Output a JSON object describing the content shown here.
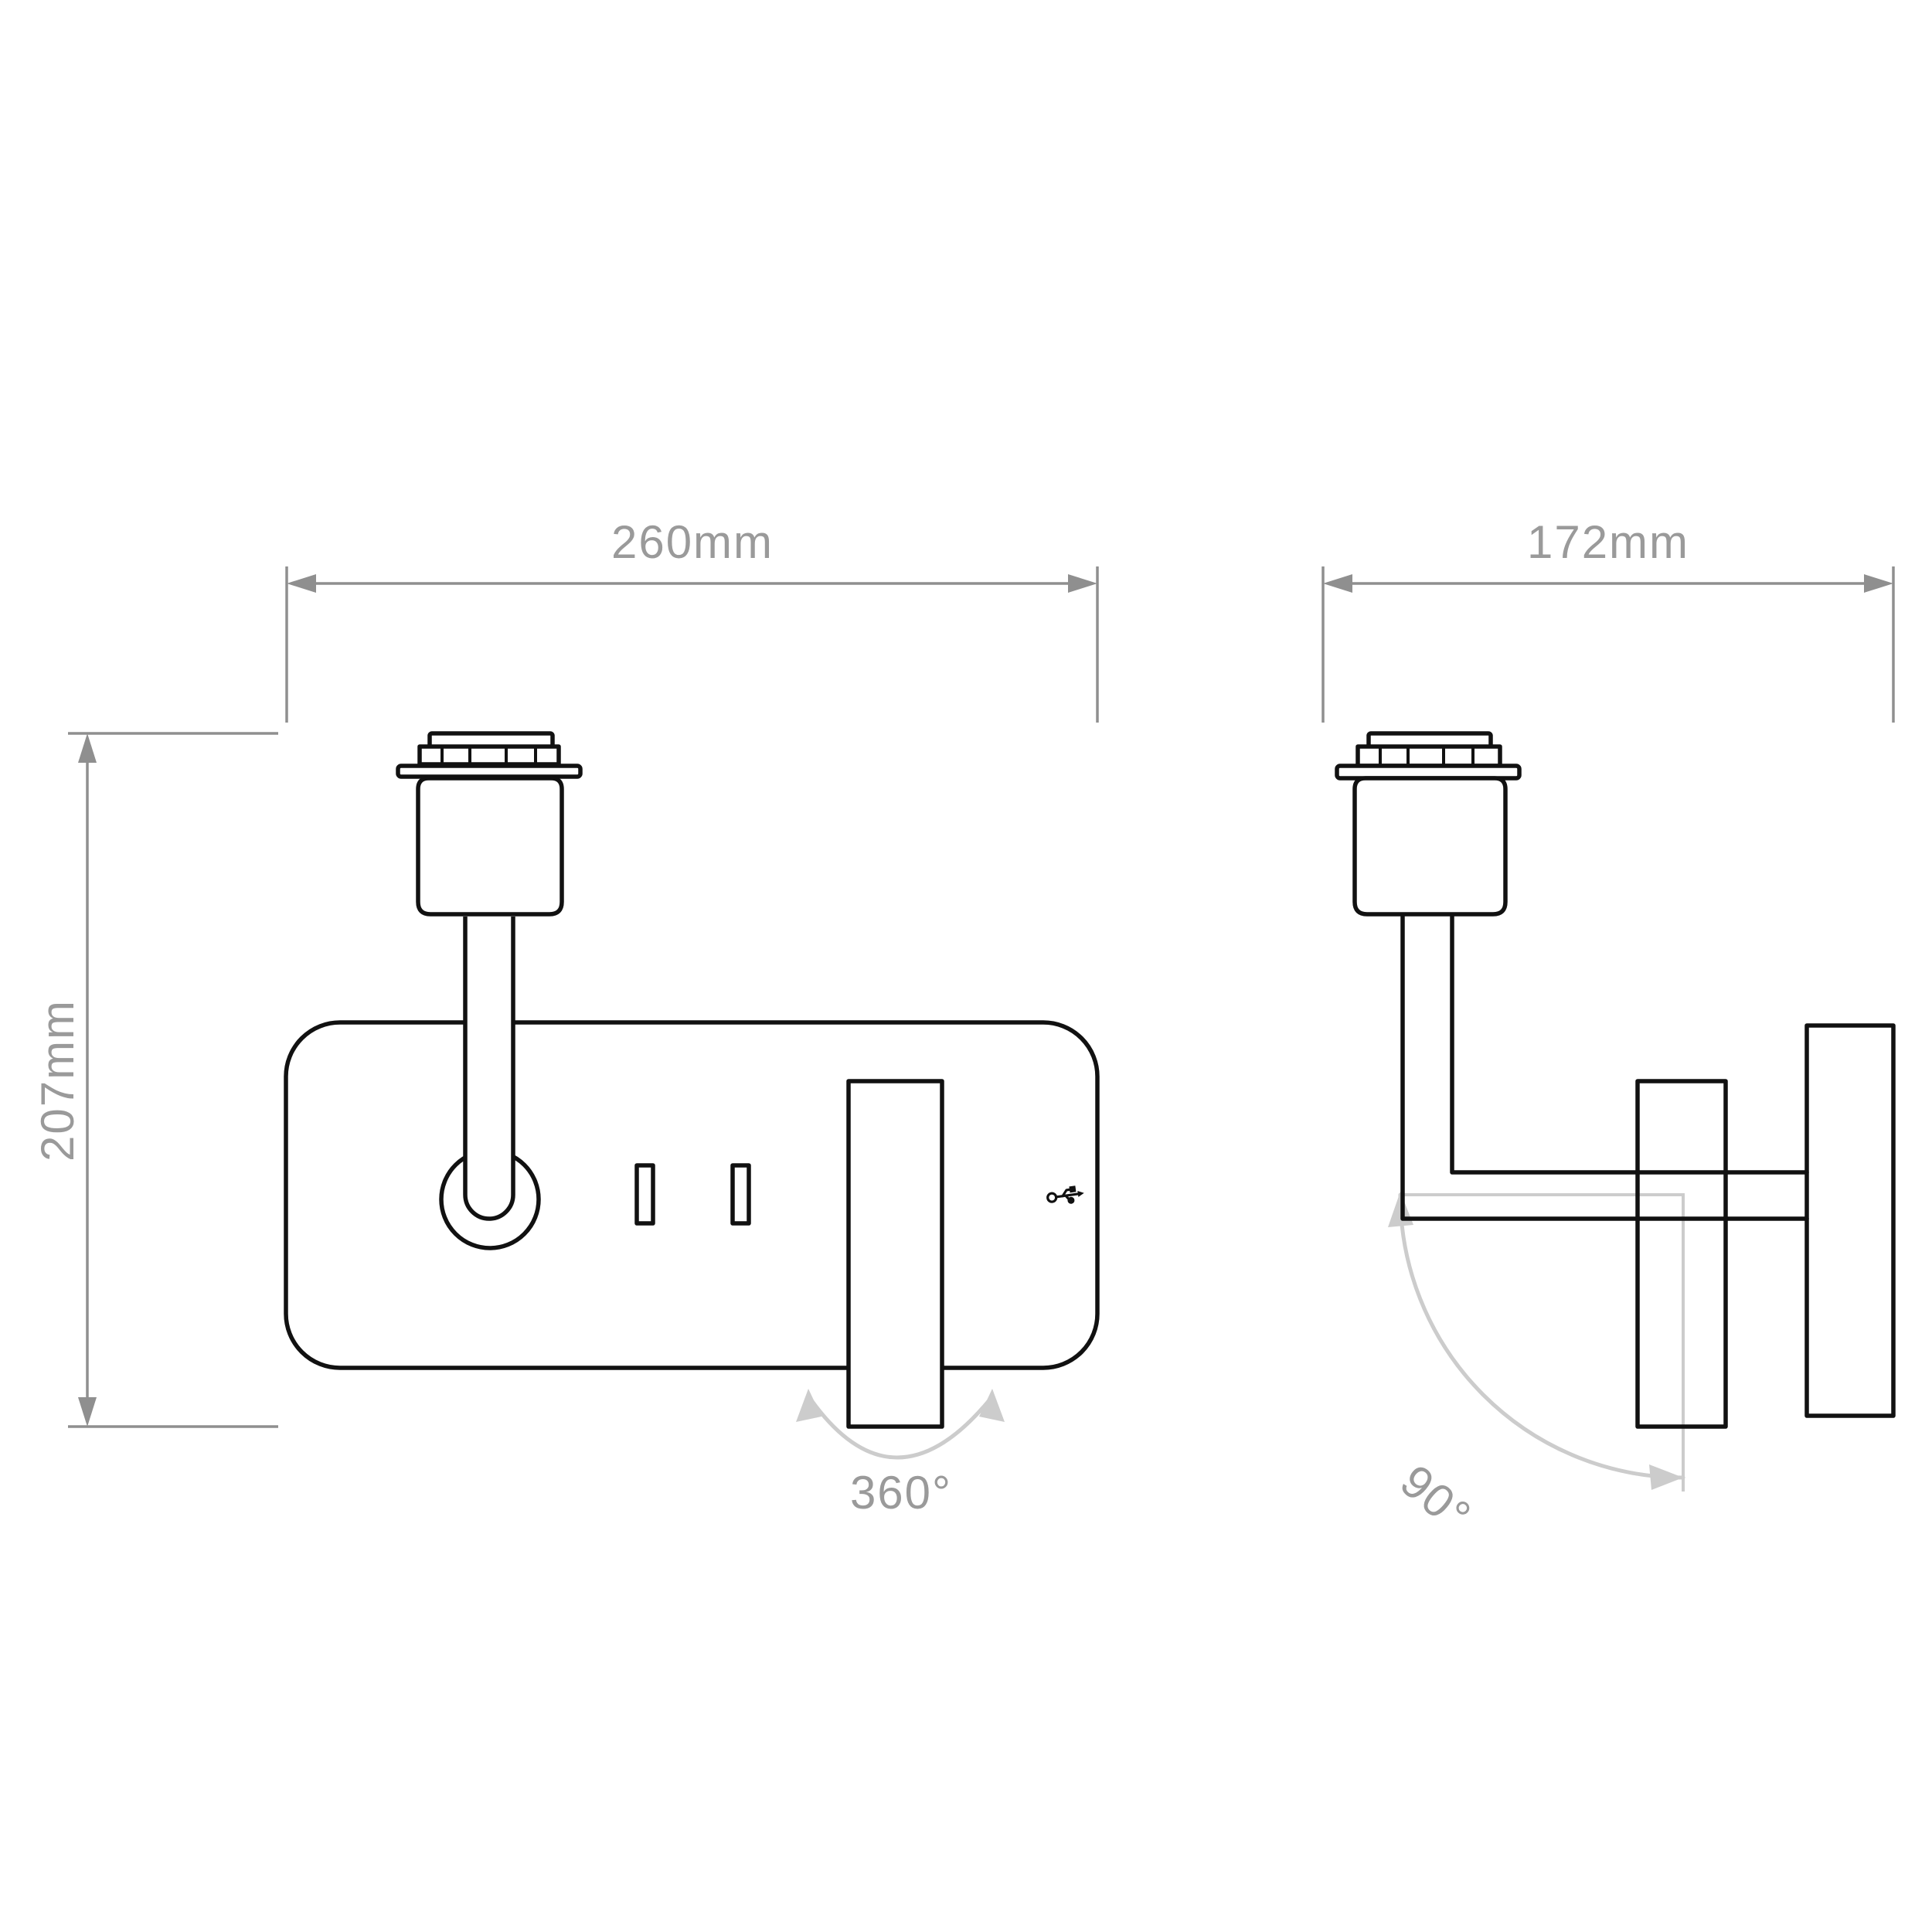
{
  "title": "wall-light-technical-drawing",
  "colors": {
    "background": "#ffffff",
    "outline": "#111111",
    "dimension": "#8f8f8f",
    "label": "#9a9a9a",
    "angle_arc": "#cccccc"
  },
  "front_view": {
    "width_dimension": "260mm",
    "height_dimension": "207mm",
    "rotation_range": "360°"
  },
  "side_view": {
    "depth_dimension": "172mm",
    "tilt_range": "90°"
  }
}
